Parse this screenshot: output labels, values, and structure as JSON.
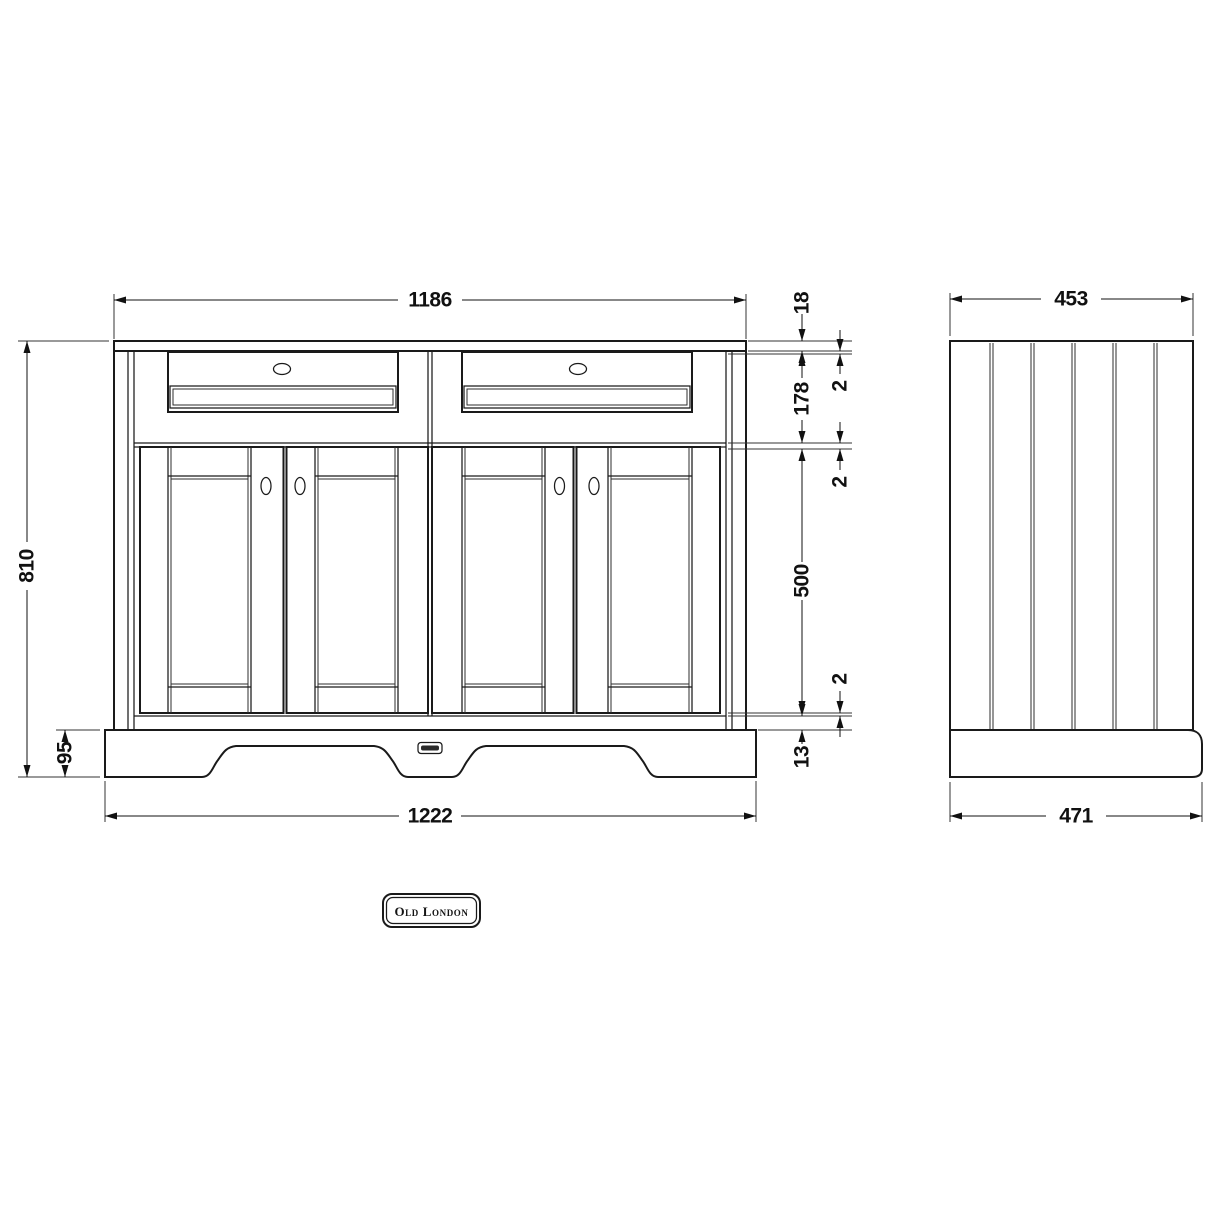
{
  "front_view": {
    "width_top": "1186",
    "width_bottom": "1222",
    "height_total": "810",
    "plinth_height": "95",
    "stack": {
      "countertop": "18",
      "gap_top": "2",
      "drawer_section": "178",
      "gap_middle": "2",
      "door_section": "500",
      "gap_bottom": "2",
      "bottom_rail": "13"
    }
  },
  "side_view": {
    "depth_top": "453",
    "depth_bottom": "471"
  },
  "branding": {
    "logo_text": "Old London"
  },
  "colors": {
    "line": "#1a1a1a",
    "background": "#ffffff"
  }
}
